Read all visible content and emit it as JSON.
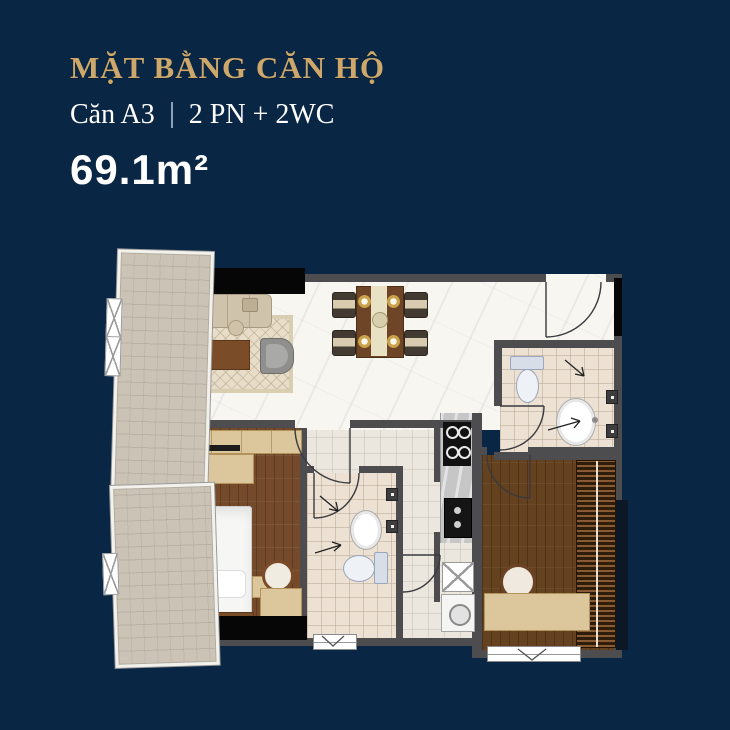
{
  "header": {
    "title": "MẶT BẰNG CĂN HỘ",
    "unit_name": "Căn A3",
    "unit_spec": "2 PN + 2WC",
    "area": "69.1m²"
  },
  "colors": {
    "background": "#0a2645",
    "title_gold": "#cda86a",
    "text_white": "#ffffff",
    "wall_gray": "#4d4d50",
    "black_accent": "#060606",
    "marble_floor": "#f8f6f1",
    "wood_floor_dark": "#64411f",
    "wood_floor_warm": "#744a2b",
    "balcony_tile": "#cbc4b6",
    "bath_tile": "#ece1d3",
    "light_wood_furniture": "#dcc69c",
    "toilet_blue_gray": "#d8dee8"
  },
  "floor_plan": {
    "rooms": [
      "balcony",
      "living-room",
      "dining-area",
      "entry",
      "bathroom-1",
      "kitchen",
      "hall",
      "laundry-nook",
      "bedroom-1",
      "bathroom-2",
      "bedroom-2"
    ]
  }
}
